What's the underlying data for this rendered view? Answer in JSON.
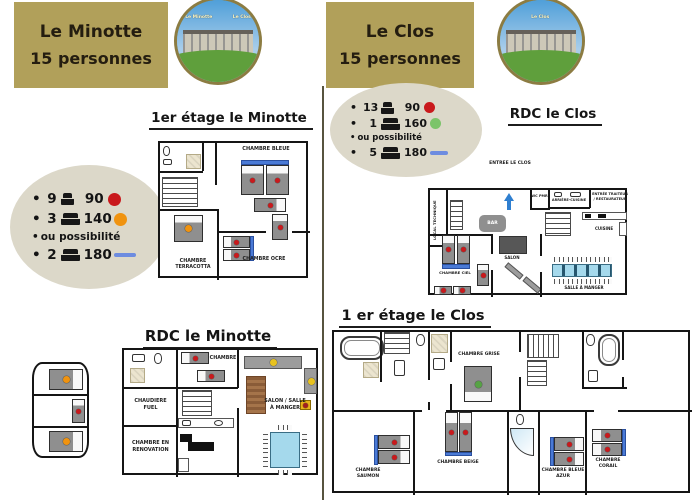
{
  "minotte": {
    "header": {
      "title": "Le Minotte",
      "subtitle": "15 personnes"
    },
    "photo": {
      "label_left": "Le Minotte",
      "label_right": "Le Clos"
    },
    "beds": {
      "r1_count": "9",
      "r1_size": "90",
      "r2_count": "3",
      "r2_size": "140",
      "note": "ou possibilité",
      "r3_count": "2",
      "r3_size": "180"
    },
    "floor1": {
      "title": "1er étage  le Minotte",
      "chambre_bleue": "CHAMBRE BLEUE",
      "chambre_terracotta": "CHAMBRE TERRACOTTA",
      "chambre_ocre": "CHAMBRE OCRE"
    },
    "rdc": {
      "title": "RDC le Minotte",
      "chambre": "CHAMBRE",
      "chaudiere_fuel": "CHAUDIERE FUEL",
      "chambre_en_renovation": "CHAMBRE EN RENOVATION",
      "salon_salle_a_manger": "SALON / SALLE À MANGER"
    }
  },
  "clos": {
    "header": {
      "title": "Le Clos",
      "subtitle": "15 personnes"
    },
    "photo": {
      "label": "Le Clos"
    },
    "beds": {
      "r1_count": "13",
      "r1_size": "90",
      "r2_count": "1",
      "r2_size": "160",
      "note": "ou possibilité",
      "r3_count": "5",
      "r3_size": "180"
    },
    "rdc": {
      "title": "RDC le Clos",
      "entree": "ENTREE LE CLOS",
      "wc_pmr": "WC PMR",
      "arriere_cuisine": "ARRIÈRE-CUISINE",
      "entree_traiteur": "ENTRÉE TRAITEUR / RESTAURATEUR",
      "local_technique": "LOCAL TECHNIQUE",
      "bar": "BAR",
      "cuisine": "CUISINE",
      "salon": "SALON",
      "chambre_ciel": "CHAMBRE CIEL",
      "salle_a_manger": "SALLE À MANGER"
    },
    "floor1": {
      "title": "1 er étage  le Clos",
      "chambre_grise": "CHAMBRE GRISE",
      "chambre_saumon": "CHAMBRE SAUMON",
      "chambre_beige": "CHAMBRE BEIGE",
      "chambre_bleue_azur": "CHAMBRE BLEUE AZUR",
      "chambre_corail": "CHAMBRE CORAIL"
    }
  },
  "colors": {
    "header_tan": "#b1a05a",
    "bubble_grey": "#dcd8c9",
    "marker_red": "#c9191c",
    "marker_orange": "#f0930f",
    "marker_green": "#7cc46a",
    "marker_blue_dash": "#6d8ce0",
    "bed_headboard_blue": "#4a7ad6",
    "table_blue": "#a5d9ec",
    "wall": "#151515"
  }
}
